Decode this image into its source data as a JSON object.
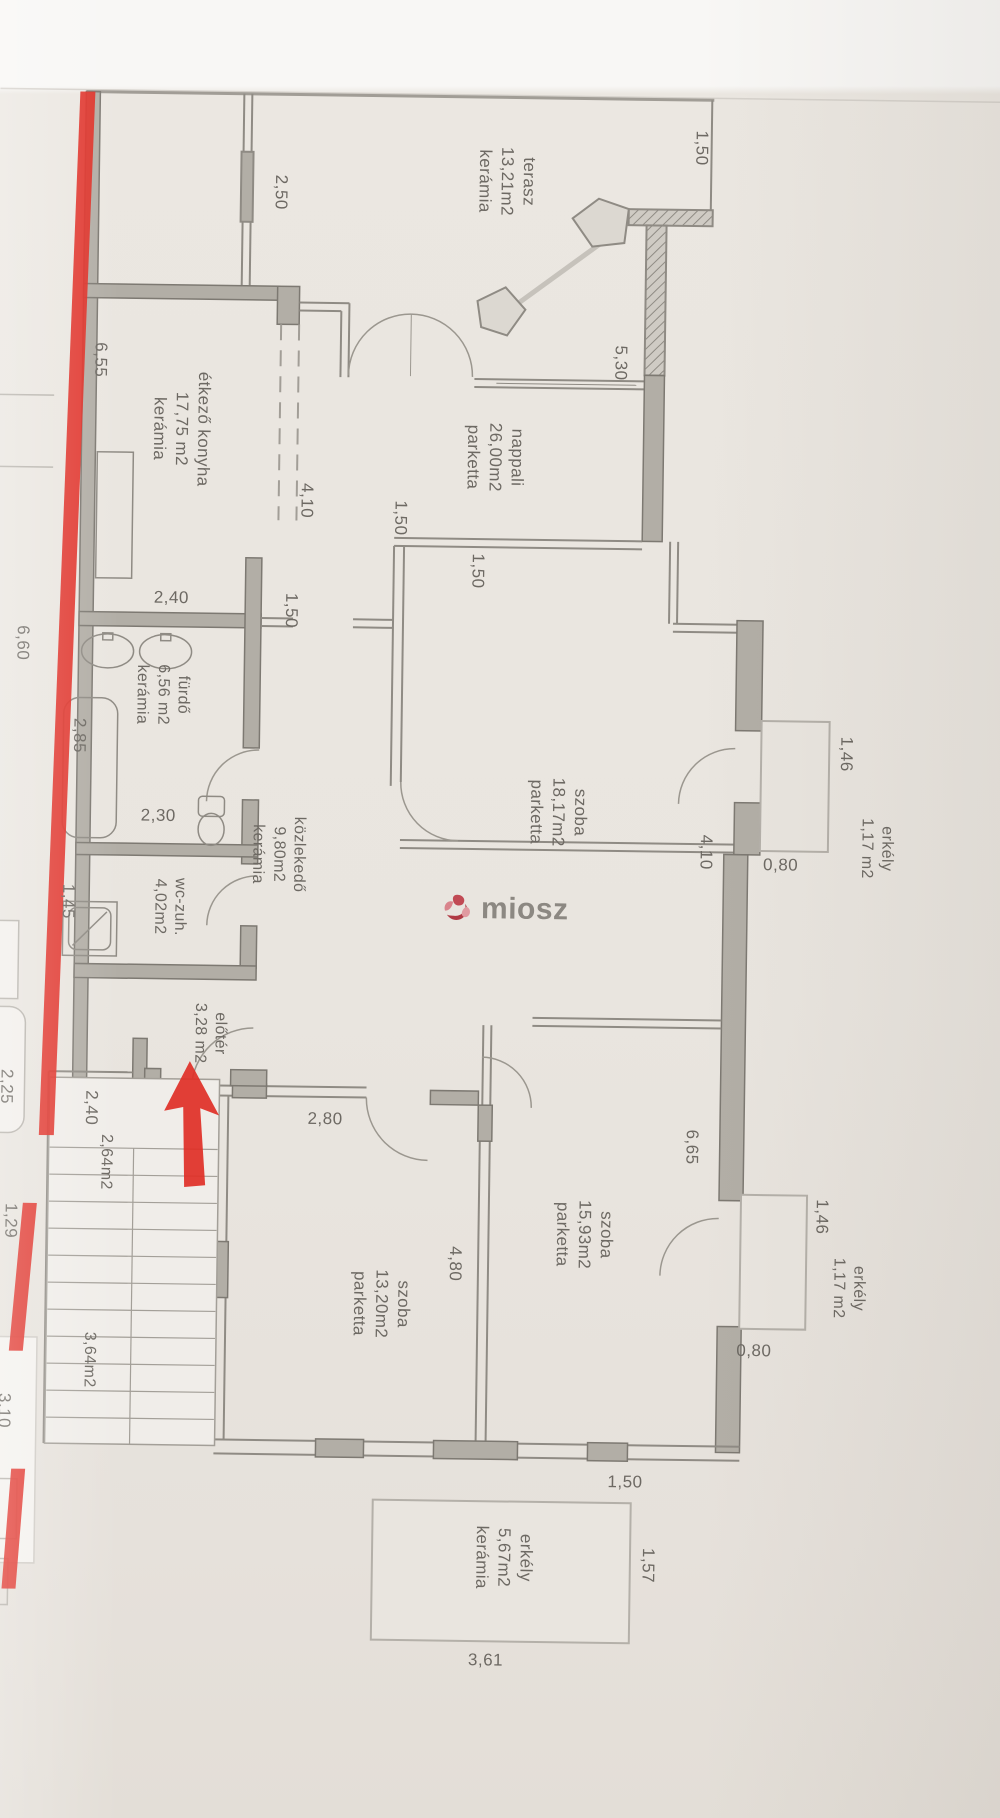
{
  "watermark": {
    "text": "miosz"
  },
  "colors": {
    "red": "#df2f26",
    "wall": "#b2aea6",
    "line": "#8f8b84",
    "text": "#6d6963",
    "paper": "#e9e5df"
  },
  "room_labels": [
    {
      "name": "room-label-terasz",
      "lines": [
        "terasz",
        "13,21m2",
        "kerámia"
      ],
      "cx": 508,
      "cy": 176,
      "rot": true,
      "fs": 17
    },
    {
      "name": "room-label-nappali",
      "lines": [
        "nappali",
        "26,00m2",
        "parketta"
      ],
      "cx": 500,
      "cy": 452,
      "rot": true,
      "fs": 17
    },
    {
      "name": "room-label-etkezo",
      "lines": [
        "étkező konyha",
        "17,75 m2",
        "kerámia"
      ],
      "cx": 186,
      "cy": 428,
      "rot": true,
      "fs": 17
    },
    {
      "name": "room-label-furdo",
      "lines": [
        "fürdő",
        "6,56 m2",
        "kerámia"
      ],
      "cx": 170,
      "cy": 694,
      "rot": true,
      "fs": 16
    },
    {
      "name": "room-label-wc-zuh",
      "lines": [
        "wc-zuh.",
        "4,02m2"
      ],
      "cx": 180,
      "cy": 906,
      "rot": true,
      "fs": 16
    },
    {
      "name": "room-label-eloter",
      "lines": [
        "előtér",
        "3,28 m2"
      ],
      "cx": 222,
      "cy": 1032,
      "rot": true,
      "fs": 16
    },
    {
      "name": "room-label-kozlekedo",
      "lines": [
        "közlekedő",
        "9,80m2",
        "kerámia"
      ],
      "cx": 288,
      "cy": 852,
      "rot": true,
      "fs": 16
    },
    {
      "name": "room-label-szoba-18",
      "lines": [
        "szoba",
        "18,17m2",
        "parketta"
      ],
      "cx": 568,
      "cy": 806,
      "rot": true,
      "fs": 17
    },
    {
      "name": "room-label-szoba-15",
      "lines": [
        "szoba",
        "15,93m2",
        "parketta"
      ],
      "cx": 600,
      "cy": 1228,
      "rot": true,
      "fs": 17
    },
    {
      "name": "room-label-szoba-13",
      "lines": [
        "szoba",
        "13,20m2",
        "parketta"
      ],
      "cx": 398,
      "cy": 1300,
      "rot": true,
      "fs": 17
    },
    {
      "name": "room-label-erkely-1",
      "lines": [
        "erkély",
        "1,17 m2"
      ],
      "cx": 886,
      "cy": 838,
      "rot": true,
      "fs": 16
    },
    {
      "name": "room-label-erkely-2",
      "lines": [
        "erkély",
        "1,17 m2"
      ],
      "cx": 864,
      "cy": 1278,
      "rot": true,
      "fs": 16
    },
    {
      "name": "room-label-erkely-3",
      "lines": [
        "erkély",
        "5,67m2",
        "kerámia"
      ],
      "cx": 524,
      "cy": 1552,
      "rot": true,
      "fs": 17
    },
    {
      "name": "area-label-2-64",
      "lines": [
        "2,64m2"
      ],
      "cx": 120,
      "cy": 1162,
      "rot": true,
      "fs": 16
    },
    {
      "name": "area-label-3-64",
      "lines": [
        "3,64m2"
      ],
      "cx": 106,
      "cy": 1360,
      "rot": true,
      "fs": 16
    }
  ],
  "dimensions": [
    {
      "text": "1,50",
      "cx": 702,
      "cy": 140,
      "rot": true
    },
    {
      "text": "2,50",
      "cx": 282,
      "cy": 190,
      "rot": true
    },
    {
      "text": "5,30",
      "cx": 624,
      "cy": 356,
      "rot": true
    },
    {
      "text": "6,55",
      "cx": 104,
      "cy": 360,
      "rot": true
    },
    {
      "text": "4,10",
      "cx": 312,
      "cy": 498,
      "rot": true
    },
    {
      "text": "1,50",
      "cx": 406,
      "cy": 514,
      "rot": true
    },
    {
      "text": "1,50",
      "cx": 484,
      "cy": 566,
      "rot": true
    },
    {
      "text": "1,50",
      "cx": 298,
      "cy": 608,
      "rot": true
    },
    {
      "text": "2,40",
      "cx": 178,
      "cy": 597,
      "rot": false
    },
    {
      "text": "6,60",
      "cx": 30,
      "cy": 644,
      "rot": true
    },
    {
      "text": "2,85",
      "cx": 88,
      "cy": 736,
      "rot": true
    },
    {
      "text": "2,30",
      "cx": 168,
      "cy": 815,
      "rot": false
    },
    {
      "text": "1,45",
      "cx": 79,
      "cy": 902,
      "rot": true
    },
    {
      "text": "1,46",
      "cx": 855,
      "cy": 744,
      "rot": true
    },
    {
      "text": "4,10",
      "cx": 716,
      "cy": 844,
      "rot": true
    },
    {
      "text": "0,80",
      "cx": 791,
      "cy": 856,
      "rot": false
    },
    {
      "text": "2,25",
      "cx": 20,
      "cy": 1088,
      "rot": true
    },
    {
      "text": "2,40",
      "cx": 105,
      "cy": 1108,
      "rot": true
    },
    {
      "text": "6,65",
      "cx": 706,
      "cy": 1139,
      "rot": true
    },
    {
      "text": "2,80",
      "cx": 339,
      "cy": 1116,
      "rot": false
    },
    {
      "text": "1,29",
      "cx": 26,
      "cy": 1222,
      "rot": true
    },
    {
      "text": "4,80",
      "cx": 471,
      "cy": 1259,
      "rot": true
    },
    {
      "text": "1,46",
      "cx": 837,
      "cy": 1207,
      "rot": true
    },
    {
      "text": "0,80",
      "cx": 771,
      "cy": 1342,
      "rot": false
    },
    {
      "text": "1,50",
      "cx": 644,
      "cy": 1475,
      "rot": false
    },
    {
      "text": "3,10",
      "cx": 22,
      "cy": 1412,
      "rot": true
    },
    {
      "text": "1,57",
      "cx": 668,
      "cy": 1558,
      "rot": true
    },
    {
      "text": "3,61",
      "cx": 507,
      "cy": 1655,
      "rot": false
    }
  ]
}
